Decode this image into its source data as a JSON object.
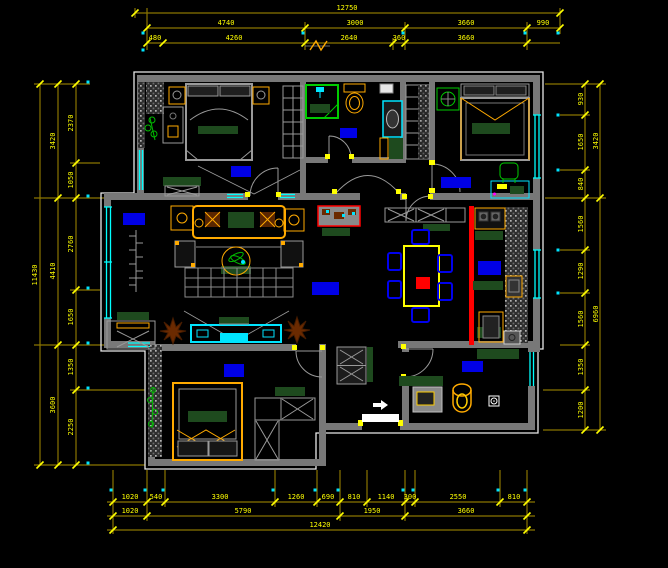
{
  "drawing": {
    "type": "apartment-floor-plan",
    "colors": {
      "background": "#000000",
      "wall": "#787878",
      "outline": "#e8e8e8",
      "dimension_line": "#8a7500",
      "dimension_text": "#ffff00",
      "window": "#00ffff",
      "furniture_accent": "#ffaa00",
      "cushion_green": "#1e4a1e",
      "fixture_green": "#00cc00",
      "label_blue": "#0000e6",
      "highlight_red": "#ff0000",
      "plant_brown": "#6b2a00"
    },
    "icons": {
      "ceiling_fan": "fan-cross",
      "entry_arrow": "right-arrow",
      "floor_drain": "circle-in-square",
      "shower_head": "spray",
      "break_mark": "zigzag"
    }
  },
  "dims": {
    "top": {
      "total": "12750",
      "row2": [
        "4740",
        "3000",
        "3660",
        "990"
      ],
      "row3": [
        "480",
        "4260",
        "2640",
        "360",
        "3660"
      ]
    },
    "bottom": {
      "row1": [
        "1020",
        "540",
        "3300",
        "1260",
        "690",
        "810",
        "1140",
        "300",
        "2550",
        "810"
      ],
      "row2": [
        "1020",
        "5790",
        "1950",
        "3660"
      ],
      "total": "12420"
    },
    "left": {
      "total": "11430",
      "row2": [
        "3420",
        "4410",
        "3600"
      ],
      "row3": [
        "2370",
        "1050",
        "2760",
        "1650",
        "1350",
        "2250"
      ]
    },
    "right": {
      "row2": [
        "3420",
        "6960"
      ],
      "row3": [
        "930",
        "1650",
        "840",
        "1560",
        "1290",
        "1560",
        "1350",
        "1200"
      ]
    }
  }
}
